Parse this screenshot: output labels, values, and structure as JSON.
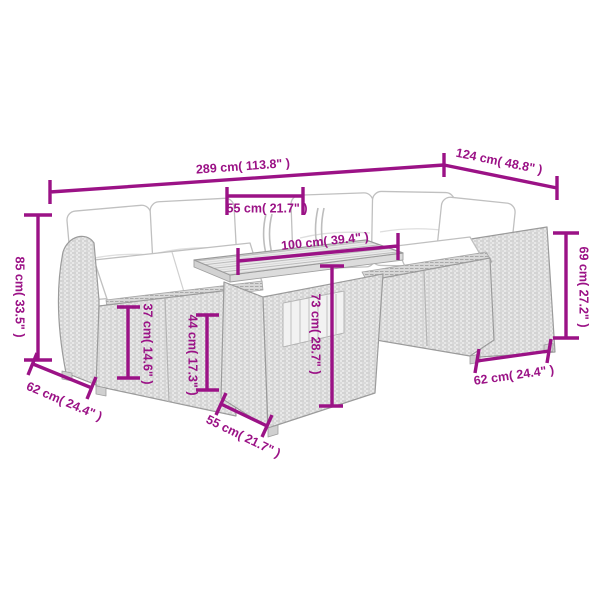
{
  "diagram": {
    "kind": "product dimension diagram",
    "subject": "rattan garden lounge sofa set with slatted-top table and white cushions"
  },
  "colors": {
    "dimension_accent": "#9B1286",
    "line_art": "#9B9B9B",
    "cushion": "#FFFFFF",
    "background": "#FFFFFF"
  },
  "dims": {
    "total_width": {
      "cm": "289",
      "in": "113.8",
      "label": "289 cm( 113.8\" )"
    },
    "right_depth": {
      "cm": "124",
      "in": "48.8",
      "label": "124 cm( 48.8\" )"
    },
    "backrest_width": {
      "cm": "55",
      "in": "21.7",
      "label": "55 cm( 21.7\" )"
    },
    "table_length": {
      "cm": "100",
      "in": "39.4",
      "label": "100 cm( 39.4\" )"
    },
    "back_height": {
      "cm": "85",
      "in": "33.5",
      "label": "85 cm( 33.5\" )"
    },
    "arm_height": {
      "cm": "69",
      "in": "27.2",
      "label": "69 cm( 27.2\" )"
    },
    "armrest_height": {
      "cm": "37",
      "in": "14.6",
      "label": "37 cm( 14.6\" )"
    },
    "seat_height": {
      "cm": "44",
      "in": "17.3",
      "label": "44 cm( 17.3\" )"
    },
    "table_height": {
      "cm": "73",
      "in": "28.7",
      "label": "73 cm( 28.7\" )"
    },
    "seat_depth_left": {
      "cm": "62",
      "in": "24.4",
      "label": "62 cm( 24.4\" )"
    },
    "table_depth": {
      "cm": "55",
      "in": "21.7",
      "label": "55 cm( 21.7\" )"
    },
    "seat_width_right": {
      "cm": "62",
      "in": "24.4",
      "label": "62 cm( 24.4\" )"
    }
  }
}
